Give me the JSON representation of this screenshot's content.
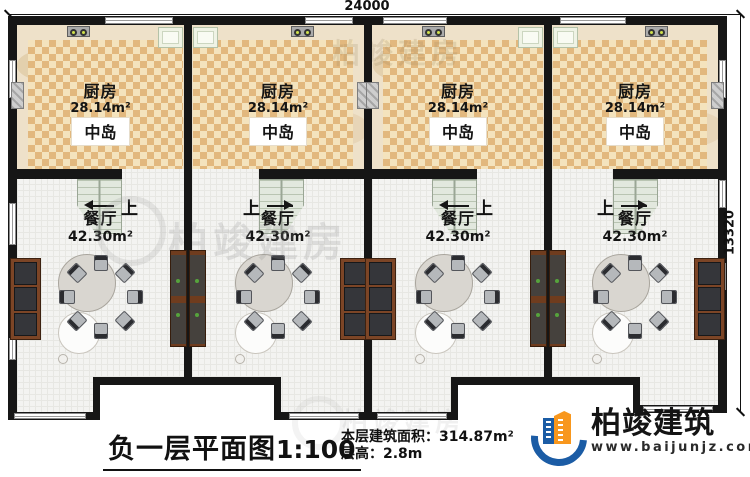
{
  "dims": {
    "top": "24000",
    "right": "13320"
  },
  "rooms": {
    "kitchen": {
      "name": "厨房",
      "area": "28.14m²",
      "island": "中岛"
    },
    "dining": {
      "name": "餐厅",
      "area": "42.30m²"
    },
    "stairs_up": "上"
  },
  "title": {
    "text": "负一层平面图",
    "scale": "1:100"
  },
  "info": {
    "area_label": "本层建筑面积：",
    "area_value": "314.87m²",
    "floor_height_label": "层高：",
    "floor_height_value": "2.8m"
  },
  "brand": {
    "name": "柏竣建筑",
    "site": "www.baijunjz.com"
  },
  "watermark": {
    "text": "柏竣建房"
  },
  "colors": {
    "wall": "#161616",
    "kitchen_tile_dark": "#e2b87e",
    "kitchen_tile_light": "#f4e3bd",
    "brand_blue": "#1b5ca5",
    "brand_orange": "#f8971d"
  }
}
